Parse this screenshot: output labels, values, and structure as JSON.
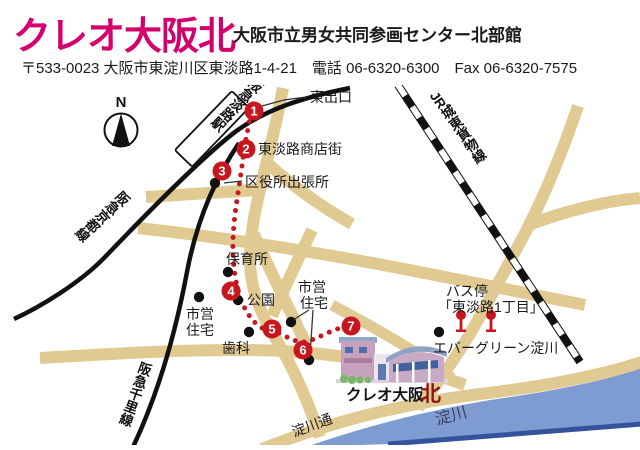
{
  "colors": {
    "title_magenta": "#d4006e",
    "route_red": "#c8161e",
    "road_tan": "#e0ca92",
    "river_blue": "#7e9cd2",
    "river_edge_blue": "#35539b",
    "building_kita_red": "#8f1414",
    "rail_black": "#111111"
  },
  "header": {
    "title": "クレオ大阪北",
    "subtitle": "大阪市立男女共同参画センター北部館",
    "address": "〒533-0023 大阪市東淀川区東淡路1-4-21　電話 06-6320-6300　Fax 06-6320-7575"
  },
  "map": {
    "compass": "N",
    "station_label": "阪急淡路駅",
    "rail_labels": {
      "hankyu_kyoto": "阪急京都線",
      "hankyu_senri": "阪急千里線",
      "jr_joto": "JR城東貨物線"
    },
    "stops": [
      "1",
      "2",
      "3",
      "4",
      "5",
      "6",
      "7"
    ],
    "labels": {
      "east_exit": "東出口",
      "shopping_street": "東淡路商店街",
      "ward_branch_office": "区役所出張所",
      "nursery_school": "保育所",
      "park": "公園",
      "municipal_housing_1_line1": "市営",
      "municipal_housing_1_line2": "住宅",
      "municipal_housing_2_line1": "市営",
      "municipal_housing_2_line2": "住宅",
      "dental_clinic": "歯科",
      "bus_stop_line1": "バス停",
      "bus_stop_line2": "「東淡路1丁目」",
      "evergreen_yodogawa": "エバーグリーン淀川",
      "yodogawa_dori": "淀川通",
      "yodogawa_river": "淀川",
      "building_name": "クレオ大阪",
      "building_kita": "北"
    }
  }
}
